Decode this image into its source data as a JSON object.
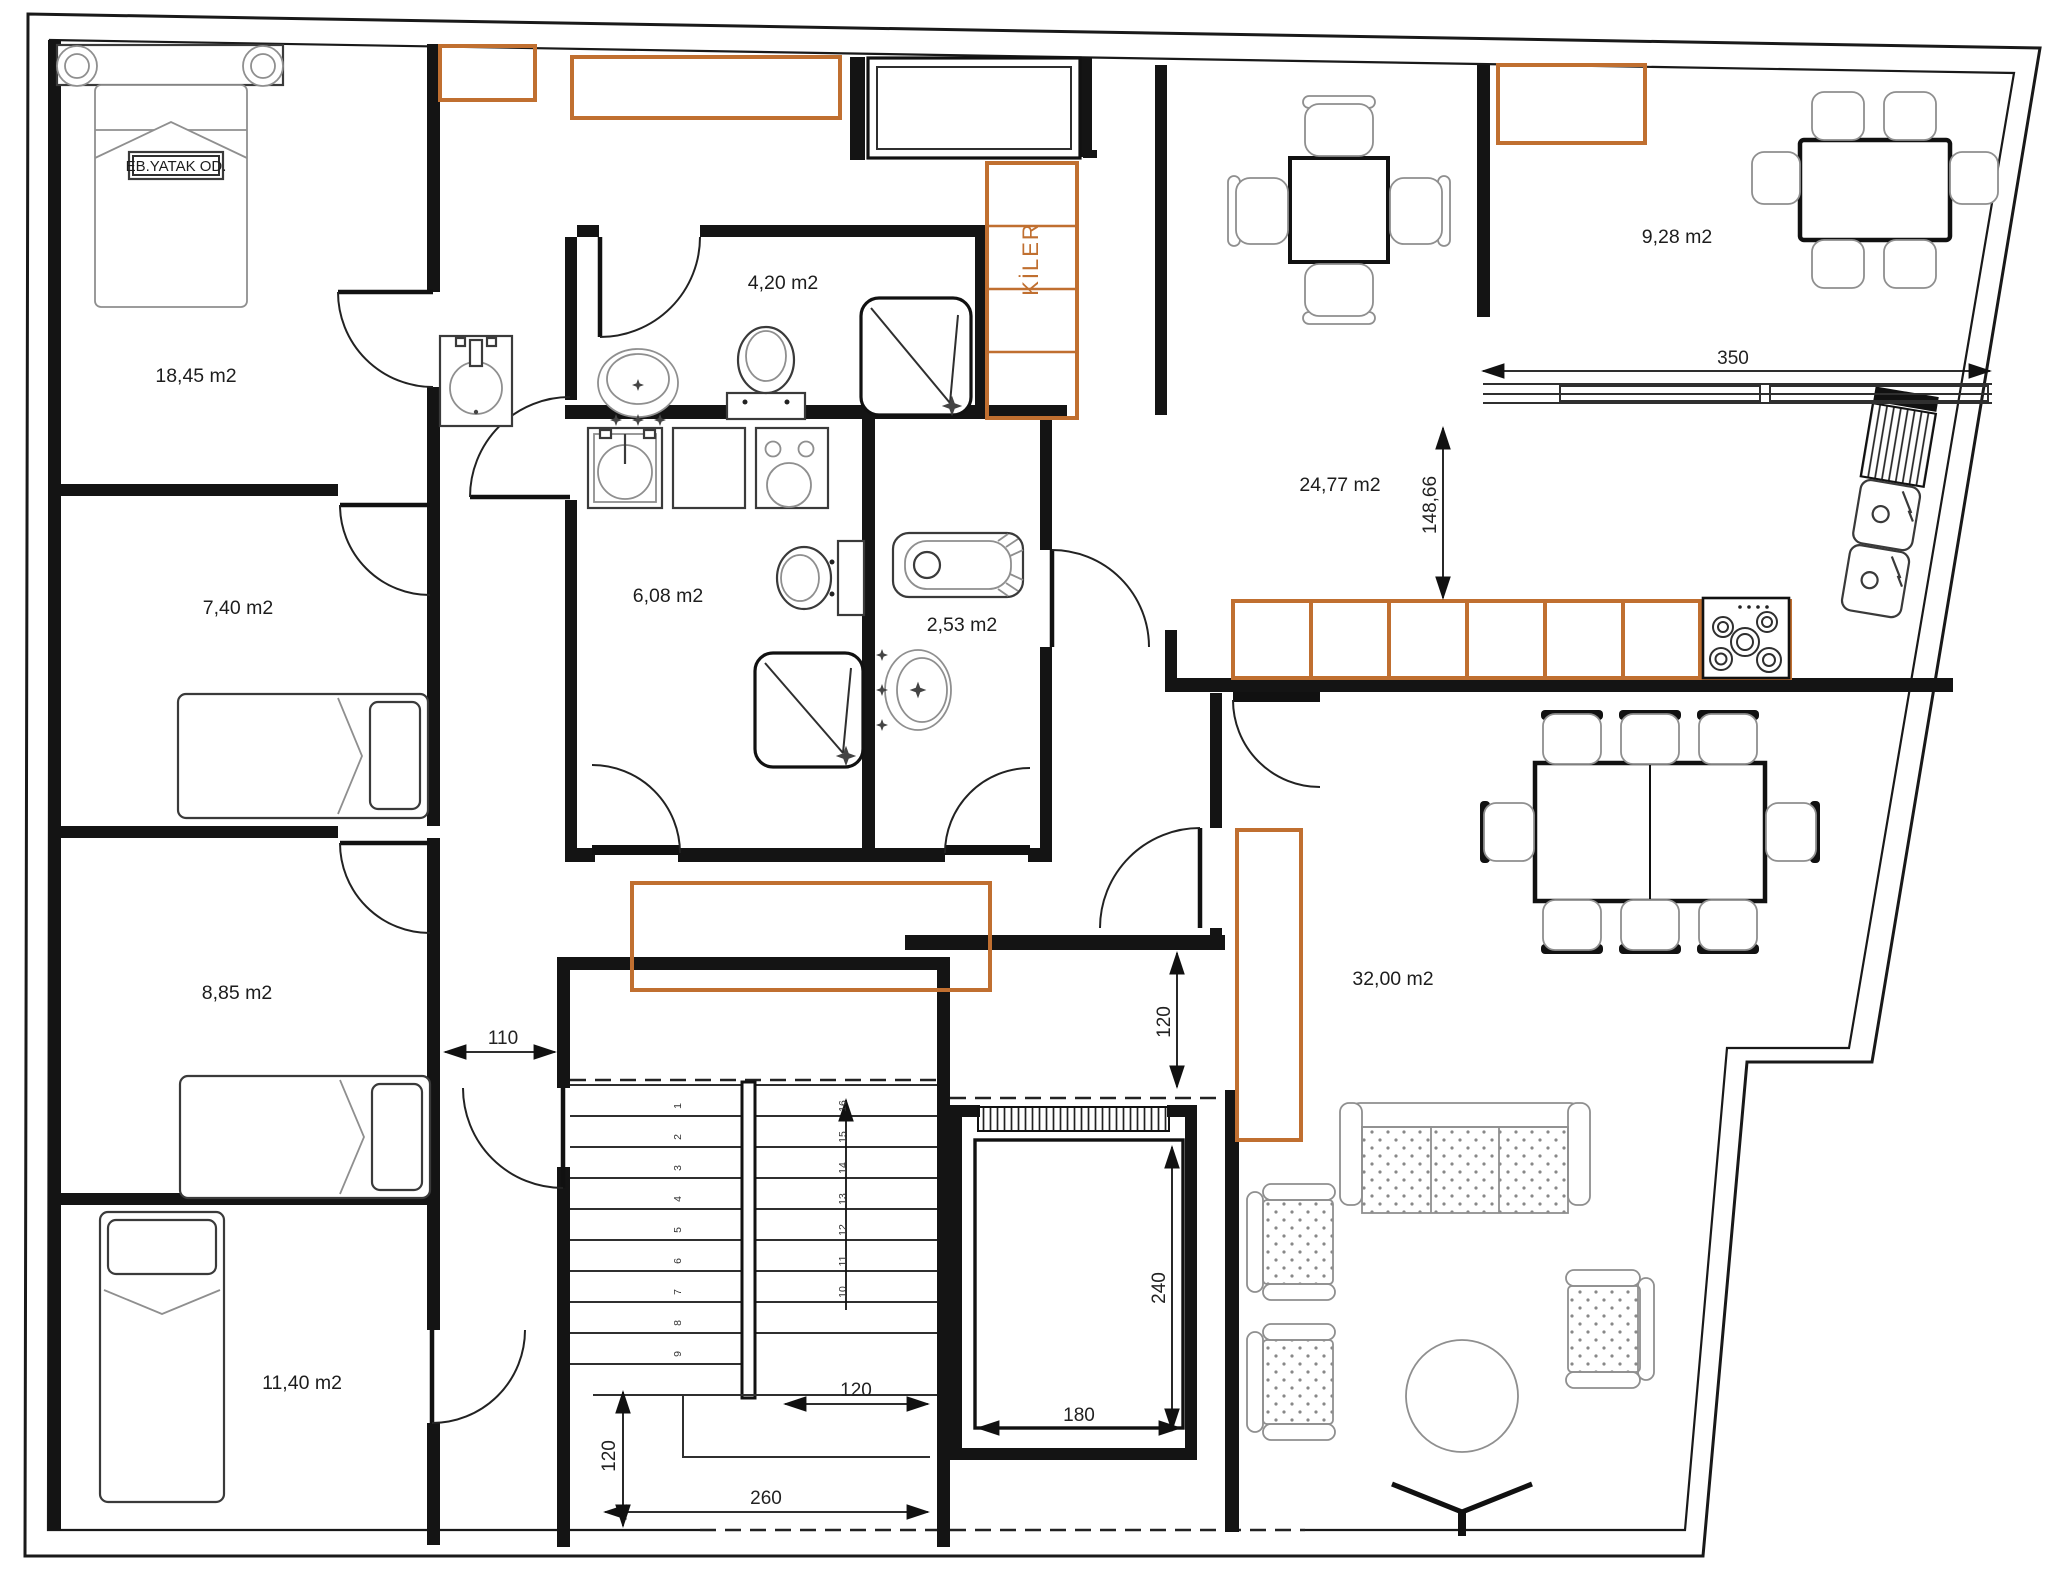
{
  "plan": {
    "rooms": {
      "master_bedroom": {
        "tag": "EB.YATAK OD.",
        "area": "18,45 m2"
      },
      "bedroom_2": {
        "area": "7,40 m2"
      },
      "bedroom_3": {
        "area": "8,85 m2"
      },
      "bedroom_4": {
        "area": "11,40 m2"
      },
      "bathroom": {
        "area": "4,20 m2"
      },
      "bathroom_2": {
        "area": "6,08 m2"
      },
      "wc": {
        "area": "2,53 m2"
      },
      "kitchen": {
        "area": "24,77 m2"
      },
      "balcony": {
        "area": "9,28 m2"
      },
      "living_room": {
        "area": "32,00 m2"
      },
      "pantry": {
        "label": "KİLER"
      }
    },
    "dimensions": {
      "balcony_window_width": "350",
      "kitchen_depth": "148,66",
      "corridor_width": "110",
      "stair_flight_width": "120",
      "stair_landing_depth": "120",
      "stair_total_width": "260",
      "hall_passage_width": "120",
      "elevator_depth": "240",
      "elevator_width": "180"
    },
    "stairs": {
      "flight_a": [
        "1",
        "2",
        "3",
        "4",
        "5",
        "6",
        "7",
        "8",
        "9"
      ],
      "flight_b": [
        "10",
        "11",
        "12",
        "13",
        "14",
        "15",
        "16"
      ]
    },
    "colors": {
      "wall": "#141414",
      "line": "#2f2f2f",
      "accent": "#c06f30",
      "furn": "#3a3a3a",
      "furnl": "#8f8f8f"
    }
  }
}
